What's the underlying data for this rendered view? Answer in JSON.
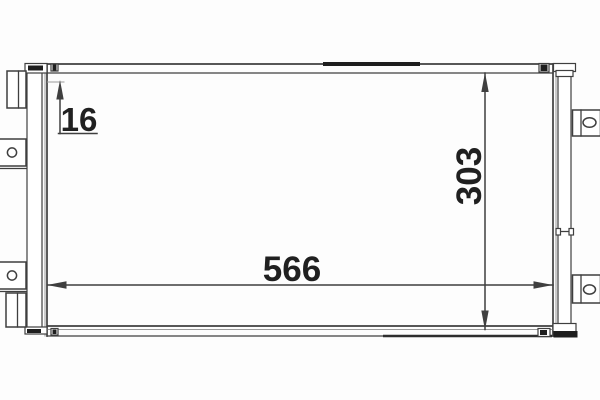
{
  "meta": {
    "description": "Technical drawing of a condenser core with overall dimensions 566 wide, 303 high and 16 deep"
  },
  "dimensions": {
    "width": {
      "label": "566"
    },
    "height": {
      "label": "303"
    },
    "depth": {
      "label": "16"
    }
  },
  "style": {
    "background": "#fdfdfd",
    "primary_line": "#3f3f3f",
    "secondary_line": "#9a9a9a",
    "dark_fill": "#1e1e1e",
    "text_color": "#202020"
  }
}
